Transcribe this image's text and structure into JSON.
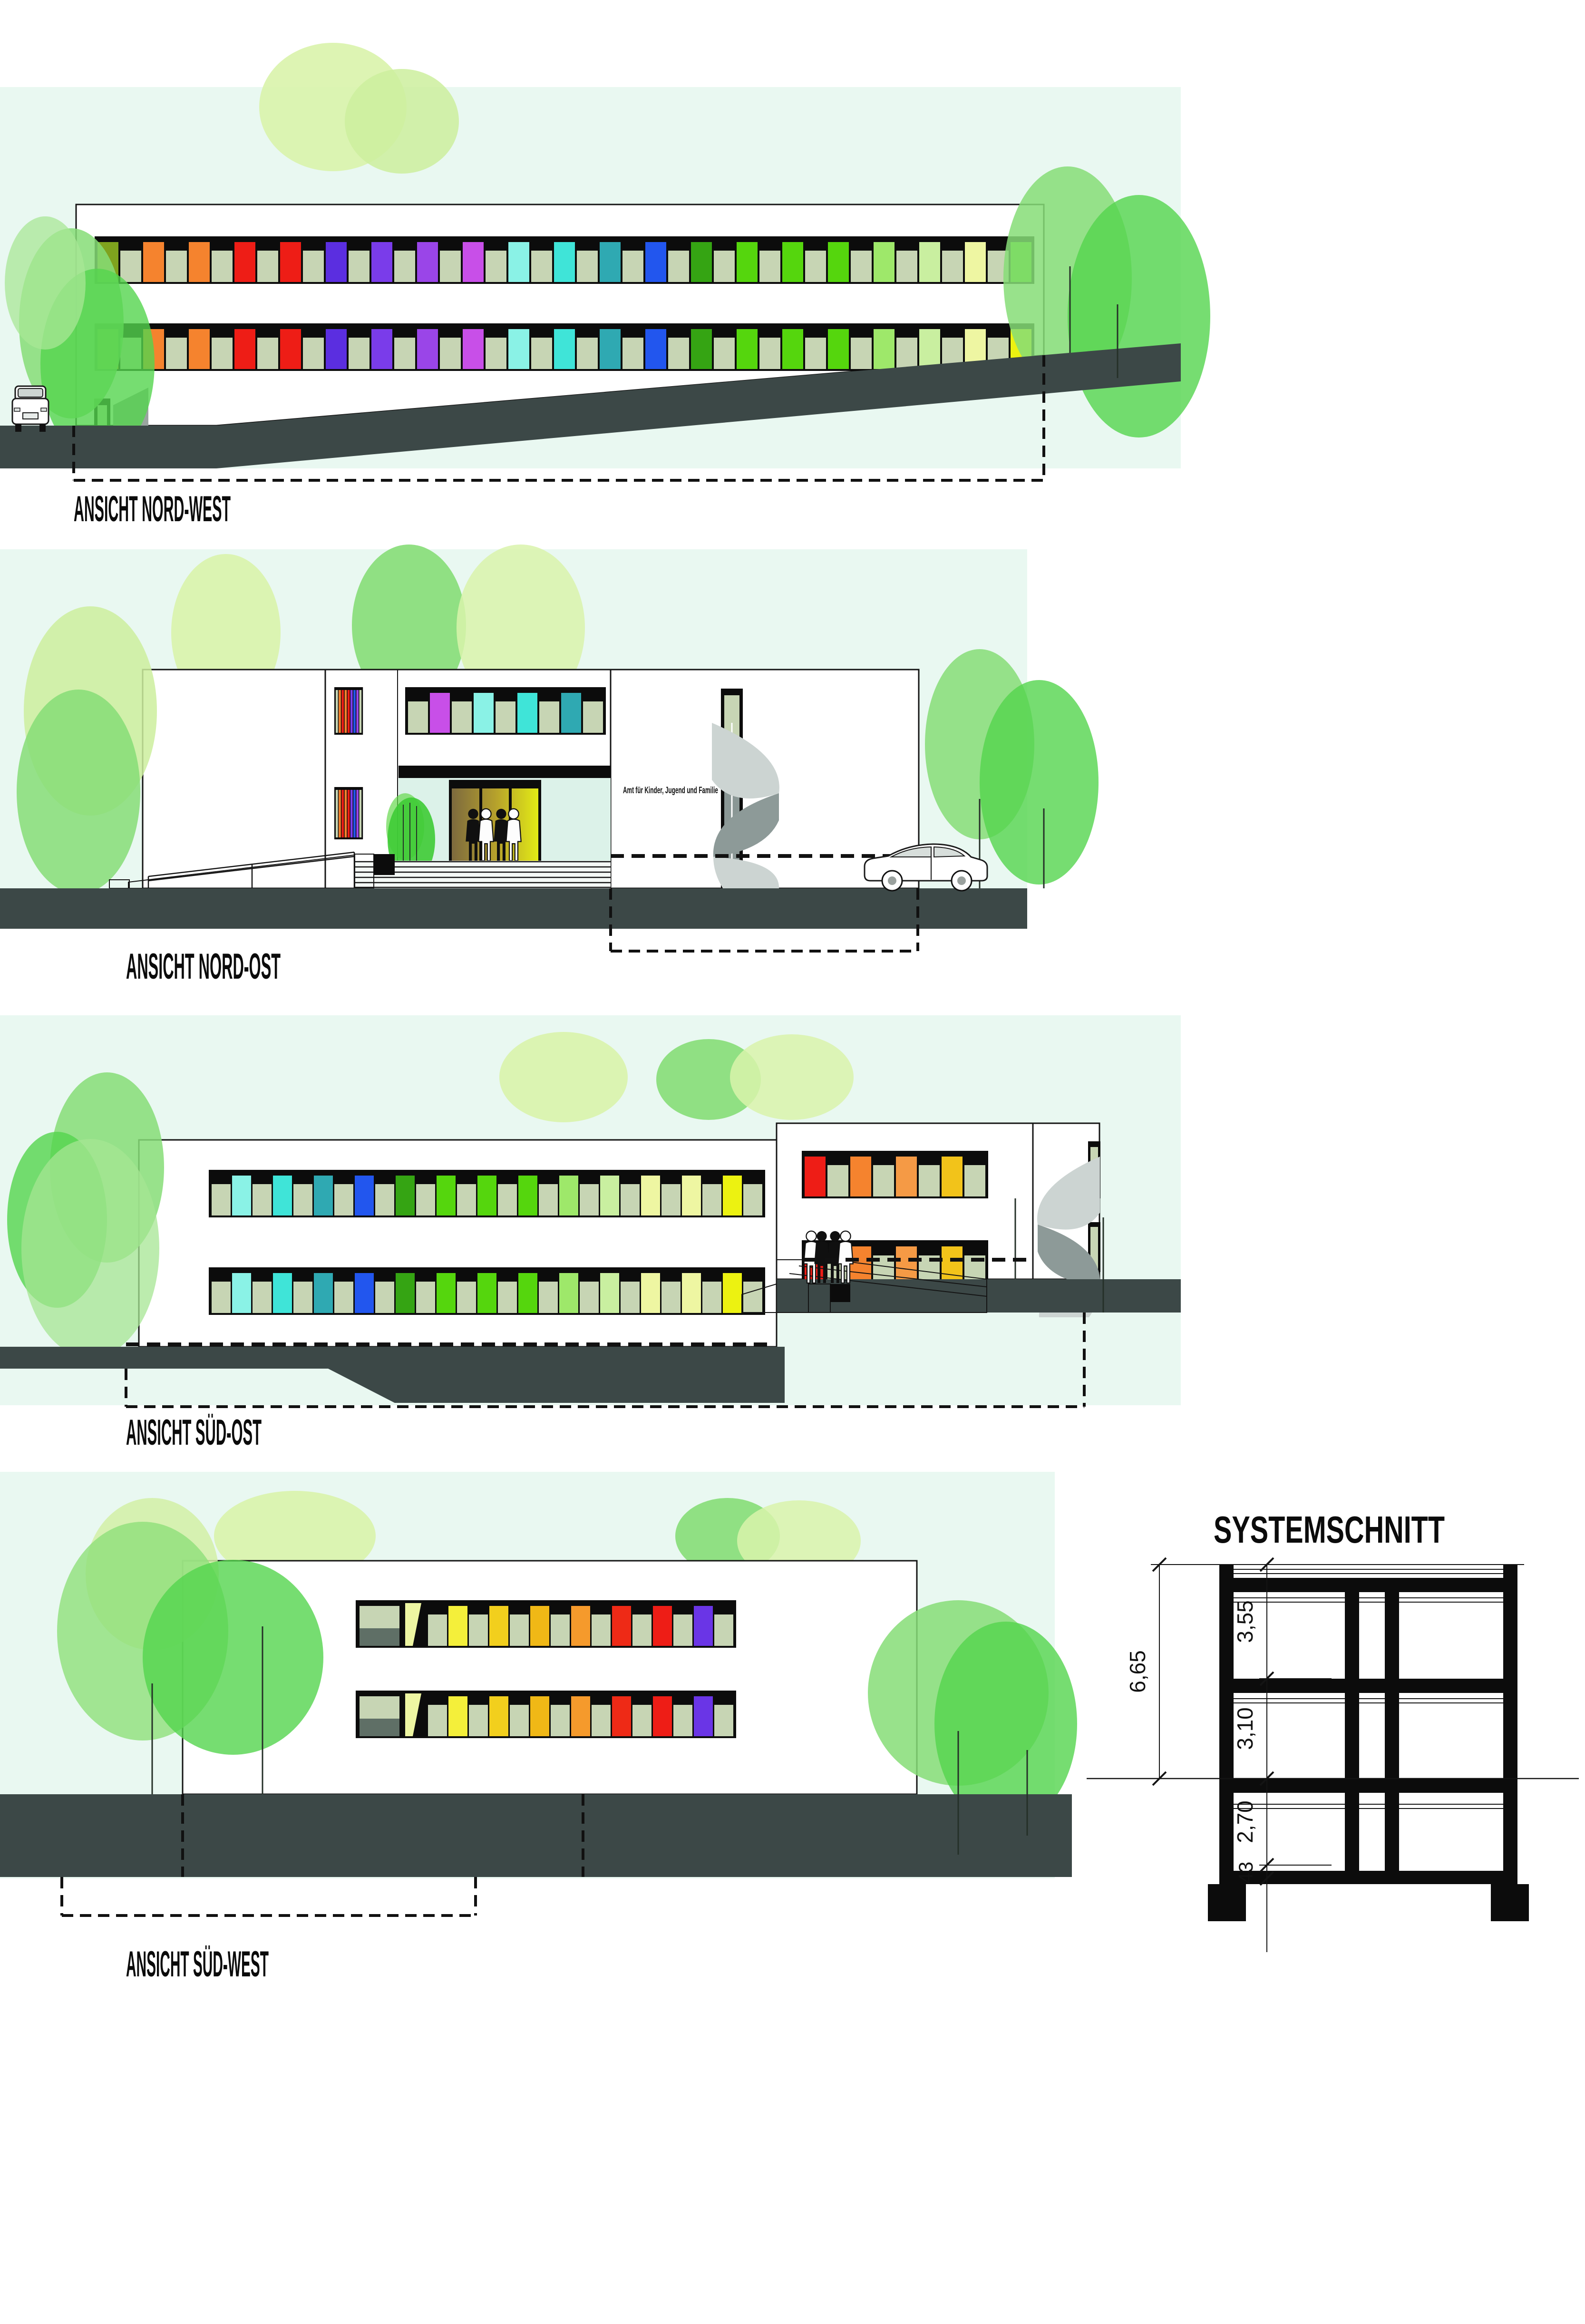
{
  "document": {
    "type": "architectural elevation sheet",
    "views": 5
  },
  "labels": {
    "nordwest": "ANSICHT NORD-WEST",
    "nordost": "ANSICHT NORD-OST",
    "suedost": "ANSICHT SÜD-OST",
    "suedwest": "ANSICHT SÜD-WEST",
    "section": "SYSTEMSCHNITT",
    "building_sign": "Amt für Kinder, Jugend und Familie"
  },
  "dimensions": {
    "total": "6,65",
    "floor_top": "3,55",
    "floor_ground": "3,10",
    "floor_basement": "2,70",
    "slab": "43"
  },
  "palette": {
    "mint": "#e9f8f1",
    "mint_entry": "#dcf2e9",
    "ground": "#3c4847",
    "frame": "#0c0c0c",
    "sage": "#c7d5b4",
    "tree_light": "#d9f3ab",
    "tree_mid": "#86dd77",
    "tree_bright": "#54d44e",
    "spiral_light": "#ccd4d2",
    "spiral_dark": "#8d9a98",
    "ramp_gray": "#e9f2ec",
    "step_gray": "#d3d9d6",
    "planter_maroon": "#5c1a14",
    "door_brown": "#7d6a3e",
    "door_yellow": "#e2ea16",
    "glass_gray": "#d7dedb"
  },
  "facades": {
    "nordwest": {
      "row1": [
        "#7fa31e",
        "sage",
        "#f5832e",
        "sage",
        "#f5832e",
        "sage",
        "#ee1d16",
        "sage",
        "#ee1d16",
        "sage",
        "#5b2ee0",
        "sage",
        "#7a3cea",
        "sage",
        "#9a45e8",
        "sage",
        "#c84fe8",
        "sage",
        "#8af2e6",
        "sage",
        "#3fe4d8",
        "sage",
        "#2fa9b2",
        "sage",
        "#2256ee",
        "sage",
        "#35a413",
        "sage",
        "#55d60d",
        "sage",
        "#55d60d",
        "sage",
        "#55d60d",
        "sage",
        "#9ee86a",
        "sage",
        "#c9efa0",
        "sage",
        "#eef6a2",
        "sage",
        "#55d60d"
      ],
      "row2": [
        "#d9a414",
        "sage",
        "#f5832e",
        "sage",
        "#f5832e",
        "sage",
        "#ee1d16",
        "sage",
        "#ee1d16",
        "sage",
        "#5b2ee0",
        "sage",
        "#7a3cea",
        "sage",
        "#9a45e8",
        "sage",
        "#c84fe8",
        "sage",
        "#8af2e6",
        "sage",
        "#3fe4d8",
        "sage",
        "#2fa9b2",
        "sage",
        "#2256ee",
        "sage",
        "#35a413",
        "sage",
        "#55d60d",
        "sage",
        "#55d60d",
        "sage",
        "#55d60d",
        "sage",
        "#9ee86a",
        "sage",
        "#c9efa0",
        "sage",
        "#eef6a2",
        "sage",
        "#ecf211"
      ]
    },
    "nordost": {
      "upper": [
        "sage",
        "#c84fe8",
        "sage",
        "#8af2e6",
        "sage",
        "#3fe4d8",
        "sage",
        "#2fa9b2",
        "sage"
      ],
      "strip": [
        "sage",
        "#f5832e",
        "#ee1d16",
        "#f5832e",
        "#ee1d16",
        "#7a3cea",
        "#2256ee",
        "#9a45e8",
        "sage"
      ]
    },
    "suedost": {
      "long": [
        "sage",
        "#8af2e6",
        "sage",
        "#3fe4d8",
        "sage",
        "#2fa9b2",
        "sage",
        "#2256ee",
        "sage",
        "#35a413",
        "sage",
        "#55d60d",
        "sage",
        "#55d60d",
        "sage",
        "#55d60d",
        "sage",
        "#9ee86a",
        "sage",
        "#c9efa0",
        "sage",
        "#eef6a2",
        "sage",
        "#eef6a2",
        "sage",
        "#ecf211",
        "sage"
      ],
      "right": [
        "#ee1d16",
        "sage",
        "#f5832e",
        "sage",
        "#f59a45",
        "sage",
        "#f2c31a",
        "sage"
      ]
    },
    "suedwest": {
      "main": [
        "sage",
        "#f4ef3a",
        "sage",
        "#f2cf1d",
        "sage",
        "#f0b816",
        "sage",
        "#f59a2c",
        "sage",
        "#ee2a16",
        "sage",
        "#ee1d16",
        "sage",
        "#6a35e6",
        "sage"
      ]
    }
  }
}
